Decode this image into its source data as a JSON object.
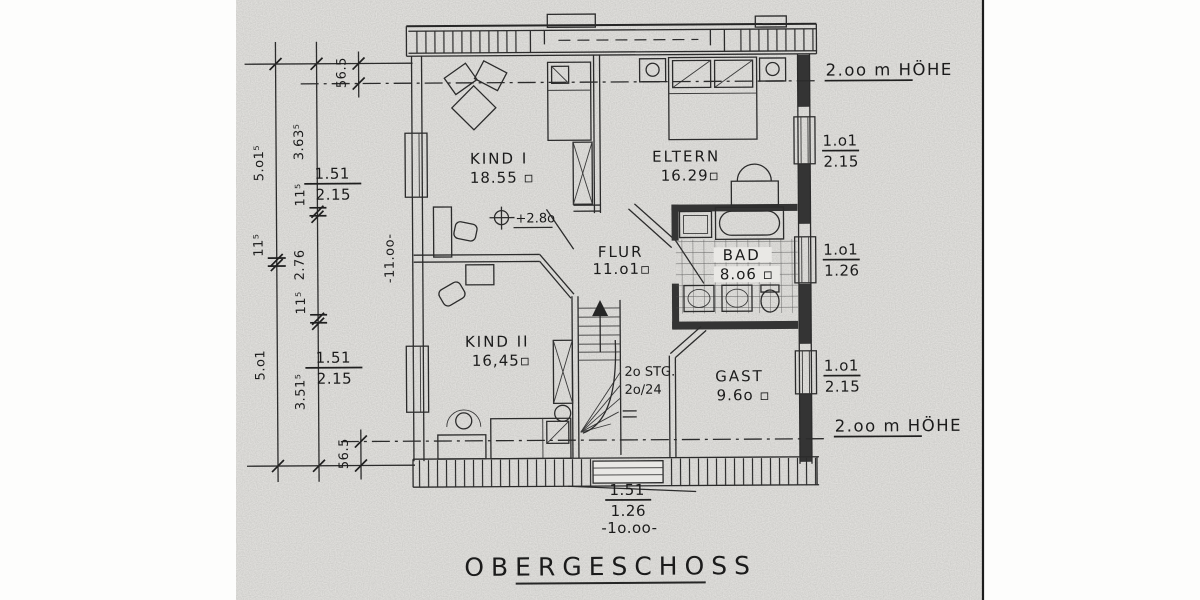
{
  "page": {
    "title": "OBERGESCHOSS"
  },
  "rooms": {
    "kind1": {
      "name": "KIND I",
      "area": "18.55 ▫"
    },
    "eltern": {
      "name": "ELTERN",
      "area": "16.29▫"
    },
    "flur": {
      "name": "FLUR",
      "area": "11.o1▫"
    },
    "bad": {
      "name": "BAD",
      "area": "8.o6 ▫"
    },
    "kind2": {
      "name": "KIND II",
      "area": "16,45▫"
    },
    "gast": {
      "name": "GAST",
      "area": "9.6o ▫"
    }
  },
  "stairs": {
    "count": "2o STG.",
    "ratio": "2o/24"
  },
  "annotations": {
    "height_top": "2.oo m HÖHE",
    "height_bottom": "2.oo m HÖHE",
    "level": "+2.8o"
  },
  "dims": {
    "outer_top": "5.o1⁵",
    "outer_wall": "11⁵",
    "outer_bottom": "5.o1",
    "inner_top": "3.63⁵",
    "inner_wall1": "11⁵",
    "inner_mid": "2.76",
    "inner_wall2": "11⁵",
    "inner_bottom": "3.51⁵",
    "offset_top": "56.5",
    "offset_bottom": "56.5",
    "interior_length": "-11.oo-",
    "win_left_top": {
      "w": "1.51",
      "h": "2.15"
    },
    "win_left_bottom": {
      "w": "1.51",
      "h": "2.15"
    },
    "win_right_top": {
      "w": "1.o1",
      "h": "2.15"
    },
    "win_right_mid": {
      "w": "1.o1",
      "h": "1.26"
    },
    "win_right_bottom": {
      "w": "1.o1",
      "h": "2.15"
    },
    "win_bottom": {
      "w": "1.51",
      "h": "1.26"
    },
    "total_width": "-1o.oo-"
  }
}
